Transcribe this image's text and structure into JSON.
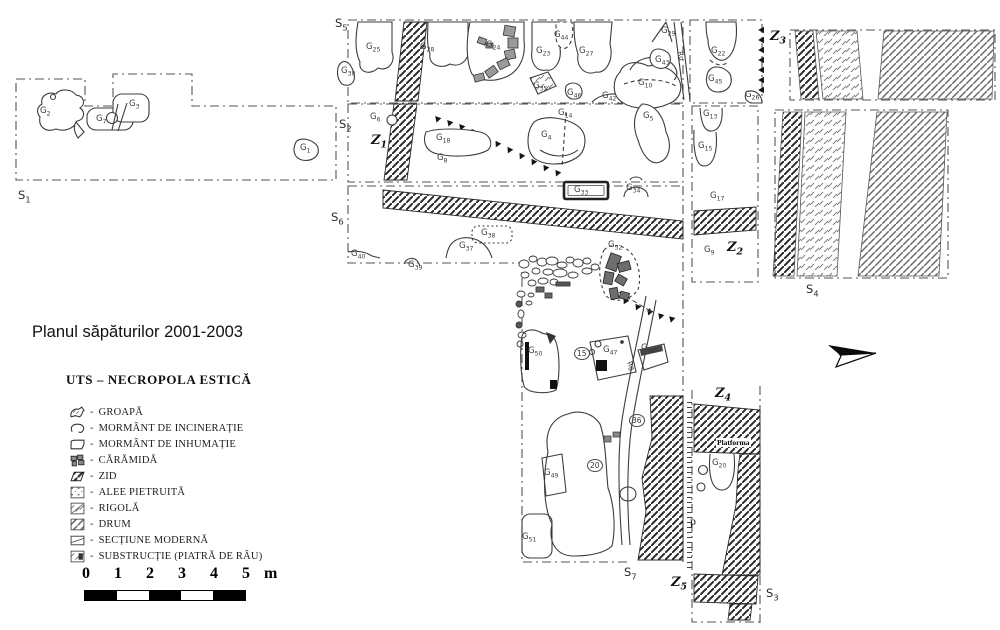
{
  "title": "Planul săpăturilor 2001-2003",
  "legend": {
    "title": "UTS – NECROPOLA ESTICĂ",
    "separator": "-",
    "items": [
      {
        "icon": "groapa",
        "label": "GROAPĂ"
      },
      {
        "icon": "incineratie",
        "label": "MORMÂNT DE INCINERAȚIE"
      },
      {
        "icon": "inhumatie",
        "label": "MORMÂNT DE INHUMAȚIE"
      },
      {
        "icon": "caramida",
        "label": "CĂRĂMIDĂ"
      },
      {
        "icon": "zid",
        "label": "ZID"
      },
      {
        "icon": "alee",
        "label": "ALEE PIETRUITĂ"
      },
      {
        "icon": "rigola",
        "label": "RIGOLĂ"
      },
      {
        "icon": "drum",
        "label": "DRUM"
      },
      {
        "icon": "sectiune",
        "label": "SECȚIUNE MODERNĂ"
      },
      {
        "icon": "substructie",
        "label": "SUBSTRUCȚIE (PIATRĂ DE RÂU)"
      }
    ]
  },
  "scale_bar": {
    "ticks": [
      "0",
      "1",
      "2",
      "3",
      "4",
      "5"
    ],
    "unit": "m",
    "segments": 5
  },
  "map": {
    "sections": [
      {
        "main": "S",
        "sub": "1",
        "x": 18,
        "y": 188
      },
      {
        "main": "S",
        "sub": "2",
        "x": 339,
        "y": 117
      },
      {
        "main": "S",
        "sub": "3",
        "x": 766,
        "y": 586
      },
      {
        "main": "S",
        "sub": "4",
        "x": 806,
        "y": 282
      },
      {
        "main": "S",
        "sub": "5",
        "x": 335,
        "y": 16
      },
      {
        "main": "S",
        "sub": "6",
        "x": 331,
        "y": 210
      },
      {
        "main": "S",
        "sub": "7",
        "x": 624,
        "y": 565
      }
    ],
    "walls": [
      {
        "main": "Z",
        "sub": "1",
        "x": 371,
        "y": 133
      },
      {
        "main": "Z",
        "sub": "2",
        "x": 727,
        "y": 240
      },
      {
        "main": "Z",
        "sub": "3",
        "x": 770,
        "y": 29
      },
      {
        "main": "Z",
        "sub": "4",
        "x": 715,
        "y": 386
      },
      {
        "main": "Z",
        "sub": "5",
        "x": 671,
        "y": 575
      }
    ],
    "graves": [
      {
        "main": "G",
        "sub": "1",
        "x": 300,
        "y": 143
      },
      {
        "main": "G",
        "sub": "2",
        "x": 40,
        "y": 106
      },
      {
        "main": "G",
        "sub": "3",
        "x": 129,
        "y": 99
      },
      {
        "main": "G",
        "sub": "7",
        "x": 96,
        "y": 114
      },
      {
        "main": "G",
        "sub": "30",
        "x": 341,
        "y": 66
      },
      {
        "main": "G",
        "sub": "25",
        "x": 366,
        "y": 42
      },
      {
        "main": "G",
        "sub": "28",
        "x": 420,
        "y": 42
      },
      {
        "main": "G",
        "sub": "24",
        "x": 486,
        "y": 40
      },
      {
        "main": "G",
        "sub": "23",
        "x": 536,
        "y": 46
      },
      {
        "main": "G",
        "sub": "44",
        "x": 554,
        "y": 30
      },
      {
        "main": "G",
        "sub": "27",
        "x": 579,
        "y": 46
      },
      {
        "main": "G",
        "sub": "29",
        "x": 661,
        "y": 26
      },
      {
        "main": "G",
        "sub": "35",
        "x": 533,
        "y": 81
      },
      {
        "main": "G",
        "sub": "46",
        "x": 567,
        "y": 88
      },
      {
        "main": "G",
        "sub": "42",
        "x": 602,
        "y": 91
      },
      {
        "main": "G",
        "sub": "43",
        "x": 655,
        "y": 55
      },
      {
        "main": "G",
        "sub": "10",
        "x": 638,
        "y": 78
      },
      {
        "main": "G",
        "sub": "5",
        "x": 643,
        "y": 111
      },
      {
        "main": "G",
        "sub": "22",
        "x": 711,
        "y": 46
      },
      {
        "main": "G",
        "sub": "45",
        "x": 708,
        "y": 74
      },
      {
        "main": "G",
        "sub": "26",
        "x": 745,
        "y": 90
      },
      {
        "main": "G",
        "sub": "6",
        "x": 370,
        "y": 112
      },
      {
        "main": "G",
        "sub": "18",
        "x": 436,
        "y": 133
      },
      {
        "main": "G",
        "sub": "8",
        "x": 437,
        "y": 153
      },
      {
        "main": "G",
        "sub": "14",
        "x": 558,
        "y": 108
      },
      {
        "main": "G",
        "sub": "4",
        "x": 541,
        "y": 130
      },
      {
        "main": "G",
        "sub": "33",
        "x": 574,
        "y": 185
      },
      {
        "main": "G",
        "sub": "34",
        "x": 626,
        "y": 183
      },
      {
        "main": "G",
        "sub": "13",
        "x": 703,
        "y": 109
      },
      {
        "main": "G",
        "sub": "15",
        "x": 698,
        "y": 141
      },
      {
        "main": "G",
        "sub": "40",
        "x": 351,
        "y": 249
      },
      {
        "main": "G",
        "sub": "39",
        "x": 408,
        "y": 260
      },
      {
        "main": "G",
        "sub": "37",
        "x": 459,
        "y": 241
      },
      {
        "main": "G",
        "sub": "38",
        "x": 481,
        "y": 228
      },
      {
        "main": "G",
        "sub": "52",
        "x": 608,
        "y": 240
      },
      {
        "main": "G",
        "sub": "17",
        "x": 710,
        "y": 191
      },
      {
        "main": "G",
        "sub": "9",
        "x": 704,
        "y": 245
      },
      {
        "main": "G",
        "sub": "50",
        "x": 528,
        "y": 346
      },
      {
        "main": "G",
        "sub": "47",
        "x": 603,
        "y": 345
      },
      {
        "main": "G",
        "sub": "48",
        "x": 641,
        "y": 343
      },
      {
        "main": "G",
        "sub": "49",
        "x": 544,
        "y": 468
      },
      {
        "main": "G",
        "sub": "51",
        "x": 522,
        "y": 532
      },
      {
        "main": "G",
        "sub": "20",
        "x": 712,
        "y": 458
      }
    ],
    "circled_numbers": [
      {
        "text": "15",
        "x": 574,
        "y": 347
      },
      {
        "text": "36",
        "x": 629,
        "y": 414
      },
      {
        "text": "20",
        "x": 587,
        "y": 459
      }
    ],
    "annotations": [
      {
        "text": "Platforma",
        "x": 716,
        "y": 438,
        "cls": "platforma"
      },
      {
        "text": "p",
        "x": 690,
        "y": 514,
        "cls": "p-note"
      },
      {
        "text": "Rg",
        "x": 676,
        "y": 52,
        "cls": "rg",
        "rotate": 75
      },
      {
        "text": "Rg",
        "x": 626,
        "y": 362,
        "cls": "rg",
        "rotate": 65
      }
    ]
  }
}
